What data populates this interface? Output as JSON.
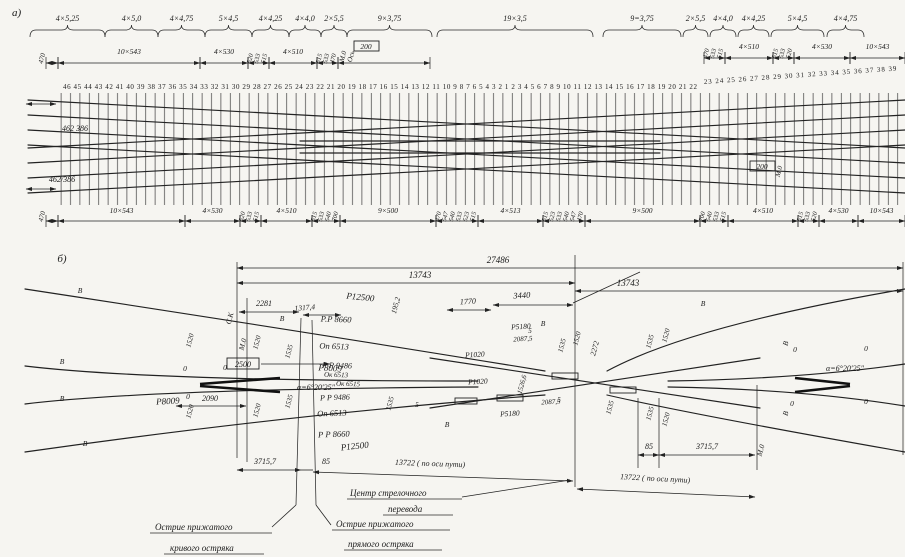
{
  "drawing": {
    "part_a_label": "а)",
    "part_b_label": "б)",
    "a": {
      "groups": [
        "4×5,25",
        "4×5,0",
        "4×4,75",
        "5×4,5",
        "4×4,25",
        "4×4,0",
        "2×5,5",
        "9×3,75",
        "19×3,5",
        "9=3,75",
        "2×5,5",
        "4×4,0",
        "4×4,25",
        "5×4,5",
        "4×4,75"
      ],
      "ties_main": "46 45 44 43 42 41 40 39 38 37 36 35 34 33 32 31 30 29 28 27 26 25 24 23 22 21 20 19 18 17 16 15 14 13 12 11 10 9 8 7 6 5 4 3 2 1 2 3 4 5 6 7 8 9 10 11 12 13 14 15 16 17 18 19 20 21 22",
      "ties_right": "23 24 25 26 27 28 29 30 31 32 33 34 35 36 37 38 39",
      "rep": {
        "s543": "10×543",
        "s530": "4×530",
        "s510": "4×510",
        "s500": "9×500",
        "s513": "4×513",
        "n470": "470",
        "n515": "515",
        "n520": "520",
        "n523": "523",
        "n533": "533",
        "n540": "540",
        "n547": "547",
        "n700": "700",
        "n200": "200",
        "m0": "М.0",
        "axis": "Ось",
        "joint_top": "462 386",
        "joint_bot": "462/386"
      }
    },
    "b": {
      "top": {
        "overall": "27486",
        "left": "13743",
        "right": "13743"
      },
      "d": {
        "n2281": "2281",
        "n1317": "1317,4",
        "n2500": "2500",
        "n2090": "2090",
        "n195": "195,2",
        "n1770": "1770",
        "n3440": "3440",
        "n1526": "1526,6",
        "n2272": "2272",
        "n2087a": "2087,5",
        "n2087b": "2087,5",
        "n85l": "85",
        "n85r": "85",
        "n3715l": "3715,7",
        "n3715r": "3715,7",
        "n13722l": "13722 ( по оси пути)",
        "n13722r": "13722 ( по оси пути)"
      },
      "r": {
        "r12500a": "Р12500",
        "r8009a": "Р8009",
        "r8009b": "Р8009",
        "r12500b": "Р12500",
        "rr8660a": "Р.Р 8660",
        "op6513a": "Оп 6513",
        "pp9486a": "Р Р 9486",
        "ok6513": "Ок 6513",
        "ok6515": "Ок 6515",
        "pp9486b": "Р Р 9486",
        "op6513b": "Оп 6513",
        "pp8660b": "Р Р 8660",
        "p1020a": "Р1020",
        "p1020b": "Р1020",
        "p5180a": "Р5180",
        "p5180b": "Р5180"
      },
      "ang": {
        "left": "α=6°20′25″",
        "right": "α=6°20′25″"
      },
      "m": {
        "ck": "С.К",
        "m0l": "М.0",
        "m0r": "М.0"
      },
      "rep": {
        "v": "В",
        "o": "0",
        "five": "5",
        "g1520": "1520",
        "g1535": "1535"
      },
      "notes": {
        "c1": "Центр стрелочного",
        "c2": "перевода",
        "l1": "Острие прижатого",
        "l2": "кривого остряка",
        "r1": "Острие прижатого",
        "r2": "прямого остряка"
      }
    }
  }
}
